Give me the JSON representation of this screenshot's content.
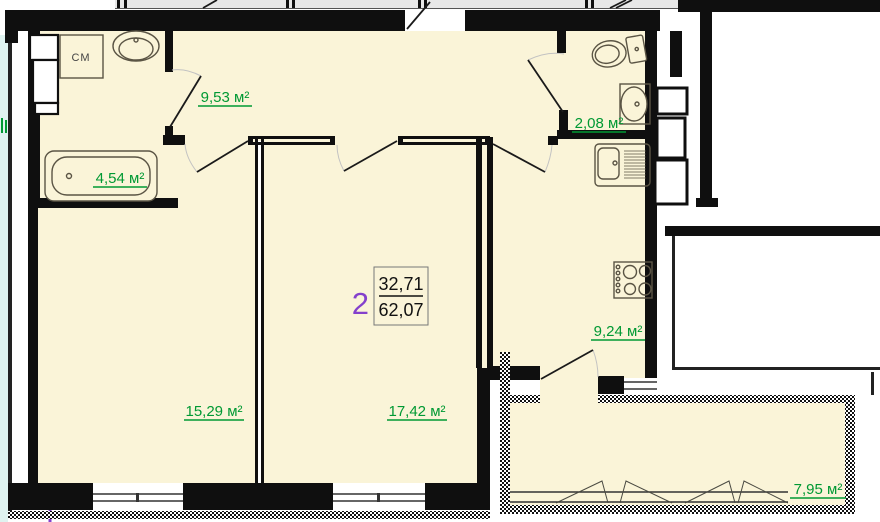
{
  "plan": {
    "apartment": {
      "number": "2",
      "living_area": "32,71",
      "total_area": "62,07"
    },
    "rooms": {
      "hall": "9,53 м²",
      "bathroom": "4,54 м²",
      "wc": "2,08 м²",
      "kitchen": "9,24 м²",
      "bedroom": "15,29 м²",
      "living_room": "17,42 м²",
      "balcony": "7,95 м²"
    },
    "fixtures": {
      "washing_machine": "СМ"
    },
    "colors": {
      "floor": "#FAF4D8",
      "area_label": "#009933",
      "apartment_number": "#8440CC",
      "wall": "#0f0f0f",
      "neighbor_floor": "#DFF3F0",
      "corridor": "#E8E8E8"
    }
  }
}
